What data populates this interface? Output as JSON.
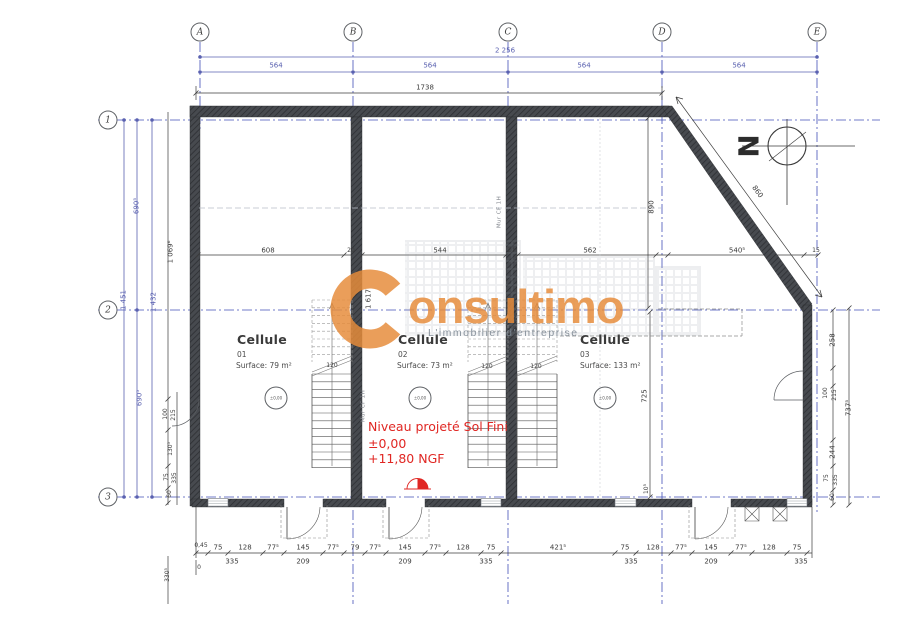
{
  "brand": {
    "name": "Consultimo",
    "logo_letter": "C",
    "name_tail": "onsultimo",
    "tagline": "L'immobilier d'entreprise",
    "orange": "#e68c3a",
    "gray": "#8a949e"
  },
  "north_label": "N",
  "grid": {
    "columns": [
      "A",
      "B",
      "C",
      "D",
      "E"
    ],
    "rows": [
      "1",
      "2",
      "3"
    ]
  },
  "cells": [
    {
      "title": "Cellule",
      "number": "01",
      "surface": "Surface: 79 m²",
      "level_mark": "±0,00"
    },
    {
      "title": "Cellule",
      "number": "02",
      "surface": "Surface: 73 m²",
      "level_mark": "±0,00"
    },
    {
      "title": "Cellule",
      "number": "03",
      "surface": "Surface: 133 m²",
      "level_mark": "±0,00"
    }
  ],
  "level_note": {
    "line1": "Niveau projeté Sol Fini",
    "line2": "±0,00",
    "line3": "+11,80 NGF",
    "color": "#e02723"
  },
  "wall_labels": [
    "Mur CF 1H",
    "Mur CF 1H"
  ],
  "stair_width": "120",
  "dimensions": {
    "top": {
      "overall": "2 256",
      "segments": [
        "564",
        "564",
        "564",
        "564"
      ],
      "building": "1738"
    },
    "left": {
      "total": "1 451",
      "inner_total": "1 432",
      "upper": "690⁵",
      "lower": "690⁵",
      "interior": "1 069⁶",
      "door_width": "100",
      "door_height": "215",
      "chain": [
        "130⁵",
        "75",
        "335",
        "60"
      ],
      "zero": "0",
      "offset": "0,45",
      "corner": "330⁵"
    },
    "mid": [
      "608",
      "20",
      "544",
      "20",
      "562",
      "540⁵",
      "15"
    ],
    "vertical": {
      "upper": "890",
      "lower": "725",
      "bottom": "10⁵",
      "diagonal": "860",
      "stair": "1 617"
    },
    "right": {
      "segments": [
        "258",
        "100",
        "215",
        "244",
        "75",
        "335",
        "60"
      ],
      "total": "737⁵"
    },
    "bottom": {
      "row1": [
        "75",
        "128",
        "77⁵",
        "145",
        "77⁵",
        "79",
        "77⁵",
        "145",
        "77⁵",
        "128",
        "75",
        "421⁵",
        "75",
        "128",
        "77⁵",
        "145",
        "77⁵",
        "128",
        "75"
      ],
      "row2": [
        "335",
        "209",
        "209",
        "335",
        "335",
        "209",
        "335"
      ]
    }
  }
}
